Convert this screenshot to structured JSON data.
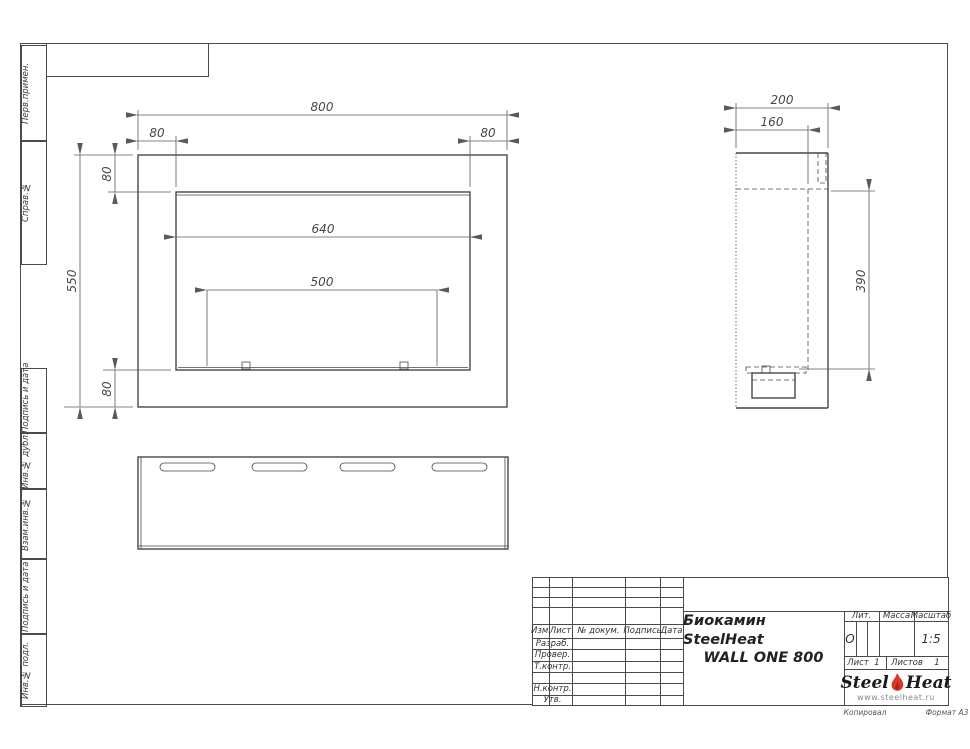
{
  "page": {
    "background": "#ffffff",
    "line_color": "#4a4a4a",
    "accent_red": "#d93a26"
  },
  "frame": {
    "left_stamps": [
      {
        "label": "Перв.примен."
      },
      {
        "label": "Справ.№"
      },
      {
        "label": "Подпись и дата"
      },
      {
        "label": "Инв.№ дубл."
      },
      {
        "label": "Взам.инв.№"
      },
      {
        "label": "Подпись и дата"
      },
      {
        "label": "Инв.№ подл."
      }
    ],
    "footer": {
      "copied": "Копировал",
      "format": "Формат А3"
    }
  },
  "views": {
    "front": {
      "dims": {
        "width": "800",
        "flange_top_left": "80",
        "flange_top_right": "80",
        "flange_side_top": "80",
        "flange_side_bottom": "80",
        "height": "550",
        "opening_width": "640",
        "burner_span": "500"
      }
    },
    "side": {
      "dims": {
        "depth": "200",
        "inner_depth": "160",
        "opening_height": "390"
      }
    }
  },
  "title_block": {
    "header_cols": [
      "Изм.",
      "Лист",
      "№ докум.",
      "Подпись",
      "Дата"
    ],
    "rows": [
      "Разраб.",
      "Провер.",
      "Т.контр.",
      "",
      "Н.контр.",
      "Утв."
    ],
    "title_line1": "Биокамин SteelHeat",
    "title_line2": "WALL ONE 800",
    "lit_label": "Лит.",
    "lit_value": "О",
    "mass_label": "Масса",
    "mass_value": "",
    "scale_label": "Масштаб",
    "scale_value": "1:5",
    "sheet_label": "Лист",
    "sheet_value": "1",
    "sheets_label": "Листов",
    "sheets_value": "1",
    "logo": {
      "part1": "Steel",
      "part2": "Heat",
      "url": "www.steelheat.ru"
    }
  }
}
